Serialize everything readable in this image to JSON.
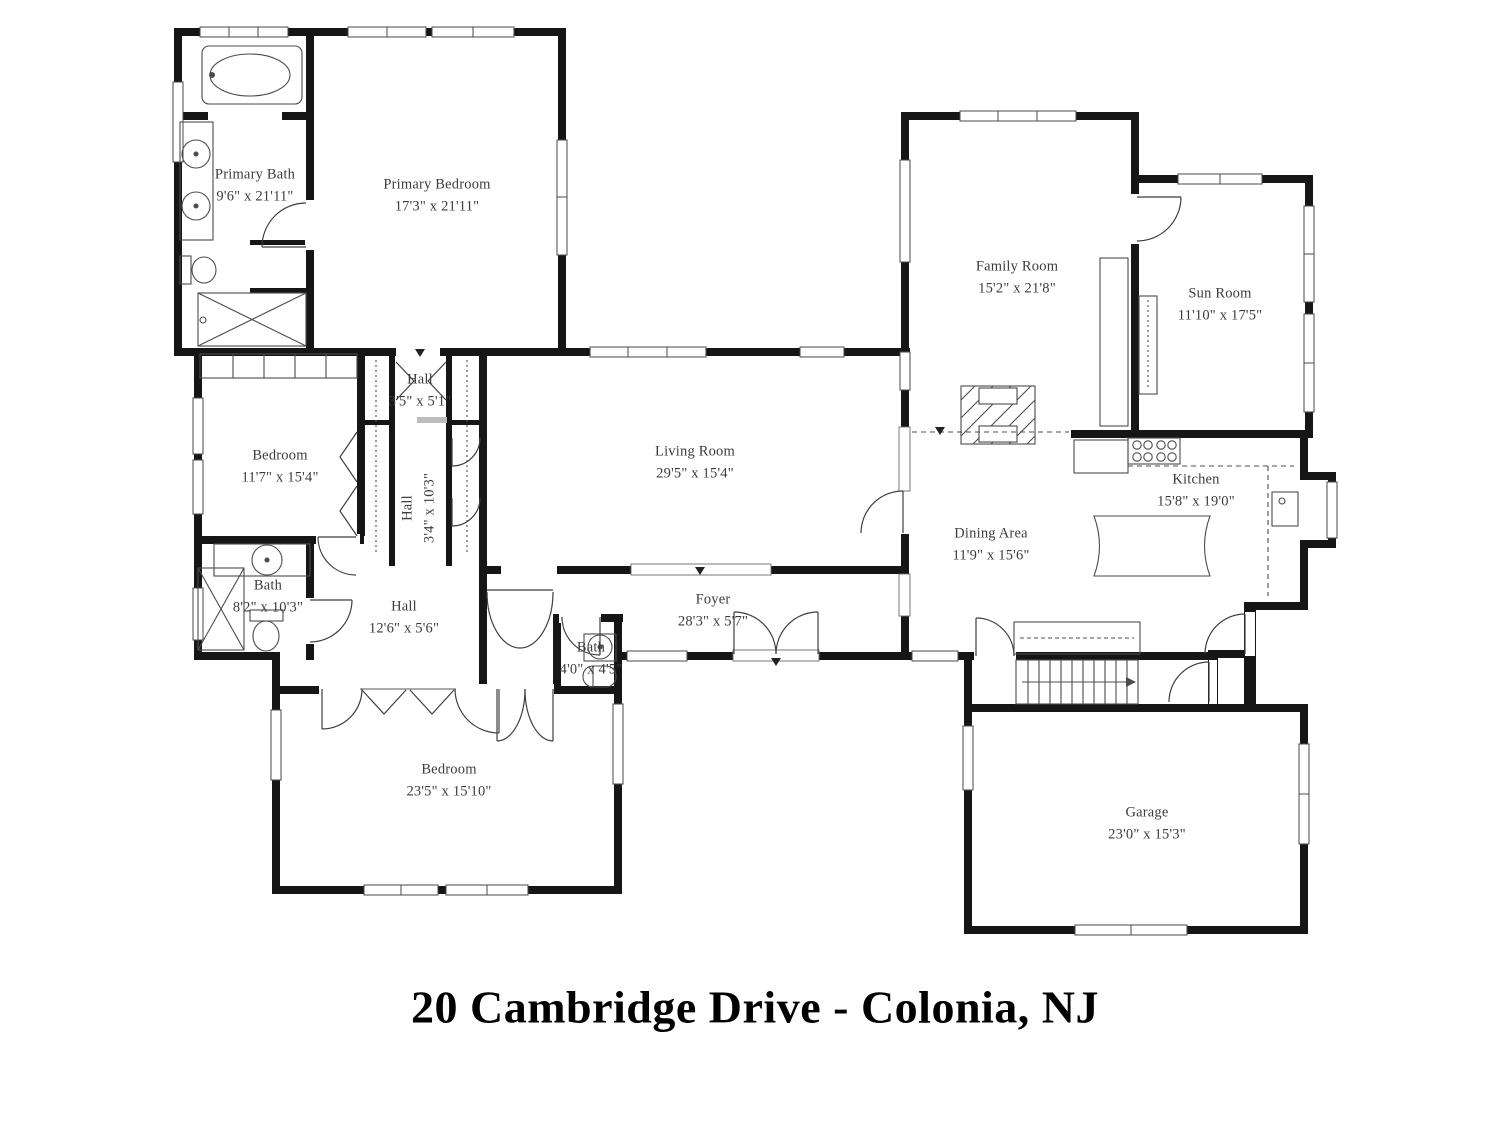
{
  "title": "20 Cambridge Drive - Colonia, NJ",
  "colors": {
    "background": "#ffffff",
    "walls": "#161616",
    "fixture_lines": "#4c4c4c",
    "label_text": "#3c3c3c",
    "title_text": "#000000"
  },
  "rooms": {
    "primary_bath": {
      "name": "Primary Bath",
      "dims": "9'6\" x 21'11\""
    },
    "primary_bedroom": {
      "name": "Primary Bedroom",
      "dims": "17'3\" x 21'11\""
    },
    "family_room": {
      "name": "Family Room",
      "dims": "15'2\" x 21'8\""
    },
    "sun_room": {
      "name": "Sun Room",
      "dims": "11'10\" x 17'5\""
    },
    "hall_upper": {
      "name": "Hall",
      "dims": "3'5\" x 5'1\""
    },
    "bedroom_mid": {
      "name": "Bedroom",
      "dims": "11'7\" x 15'4\""
    },
    "hall_mid": {
      "name": "Hall",
      "dims": "3'4\" x 10'3\""
    },
    "living_room": {
      "name": "Living Room",
      "dims": "29'5\" x 15'4\""
    },
    "kitchen": {
      "name": "Kitchen",
      "dims": "15'8\" x 19'0\""
    },
    "dining_area": {
      "name": "Dining Area",
      "dims": "11'9\" x 15'6\""
    },
    "bath_main": {
      "name": "Bath",
      "dims": "8'2\" x 10'3\""
    },
    "hall_lower": {
      "name": "Hall",
      "dims": "12'6\" x 5'6\""
    },
    "foyer": {
      "name": "Foyer",
      "dims": "28'3\" x 5'7\""
    },
    "bath_small": {
      "name": "Bath",
      "dims": "4'0\" x 4'5\""
    },
    "bedroom_lower": {
      "name": "Bedroom",
      "dims": "23'5\" x 15'10\""
    },
    "garage": {
      "name": "Garage",
      "dims": "23'0\" x 15'3\""
    }
  }
}
